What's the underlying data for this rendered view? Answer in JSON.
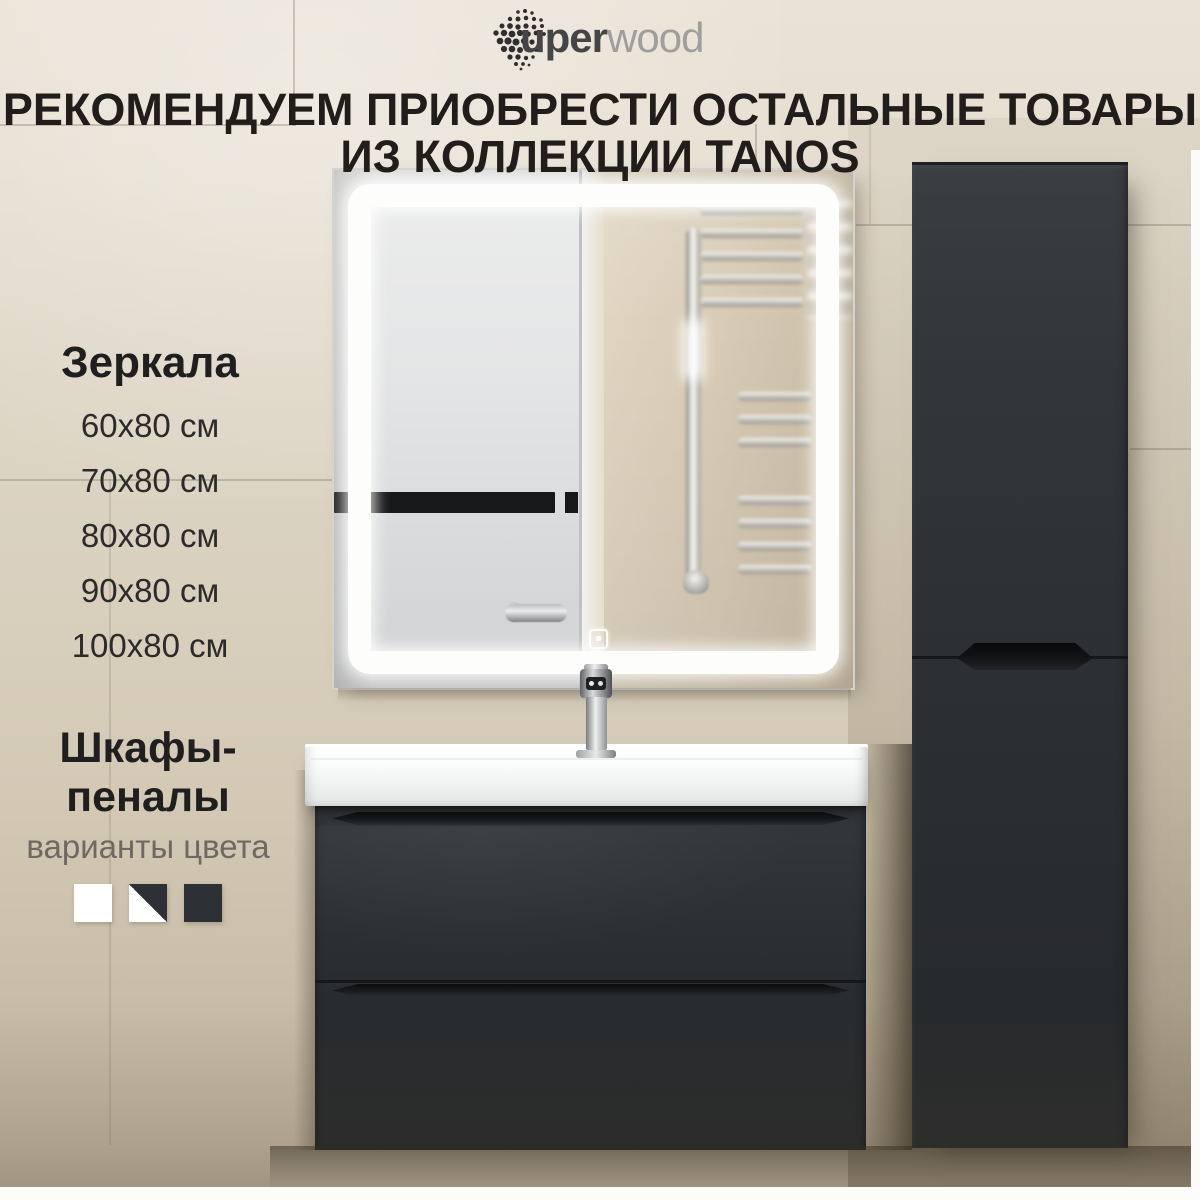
{
  "brand": {
    "logo_prefix": "uper",
    "logo_suffix": "wood"
  },
  "headline": {
    "line1": "РЕКОМЕНДУЕМ ПРИОБРЕСТИ ОСТАЛЬНЫЕ ТОВАРЫ",
    "line2": "ИЗ КОЛЛЕКЦИИ TANOS"
  },
  "mirrors": {
    "title": "Зеркала",
    "sizes": [
      "60x80 см",
      "70x80 см",
      "80x80 см",
      "90x80 см",
      "100x80 см"
    ]
  },
  "pencil_cabinets": {
    "title": "Шкафы-пеналы",
    "subtitle": "варианты цвета",
    "color_options": [
      {
        "name": "white",
        "hex": "#ffffff"
      },
      {
        "name": "white-dark-split",
        "hex": "#ffffff / #2d3136"
      },
      {
        "name": "dark-graphite",
        "hex": "#2d3136"
      }
    ]
  },
  "palette": {
    "wall_beige": "#ddd4c4",
    "furniture_dark": "#2d3136",
    "led_white": "#ffffff",
    "text_dark": "#201d1a",
    "text_muted": "#6f6963"
  }
}
